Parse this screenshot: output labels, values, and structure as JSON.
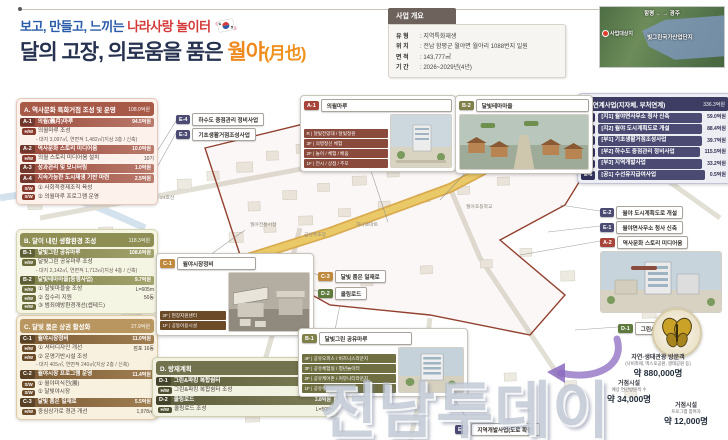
{
  "title": {
    "line1_prefix": "보고, 만들고, 느끼는",
    "line1_accent": "나라사랑 놀이터",
    "line2_prefix": "달의 고장, 의로움을 품은",
    "line2_accent": "월야",
    "line2_hanja": "(月也)"
  },
  "overview": {
    "header": "사업 개요",
    "rows": [
      {
        "k": "유 형",
        "v": ": 지역특화재생"
      },
      {
        "k": "위 치",
        "v": ": 전남 함평군 월야면 월야리 1088번지 일원"
      },
      {
        "k": "면 적",
        "v": ": 143,777㎡"
      },
      {
        "k": "기 간",
        "v": ": 2026~2029년(4년)"
      }
    ]
  },
  "locator": {
    "left_city": "함평",
    "right_city": "광주",
    "arrows": "←  →",
    "zone": "빛그린국가산업단지",
    "site": "사업대상지"
  },
  "sections": {
    "a": {
      "title": "A. 역사문화 특화거점 조성 및 운영",
      "total": "108.0억원",
      "rows": [
        {
          "cls": "head",
          "code": "A-1",
          "name": "의월(義月)마루",
          "rt": "94.5억원"
        },
        {
          "cls": "sub",
          "badge": "H/W",
          "text": "의월마루 조성"
        },
        {
          "cls": "sub note",
          "text": "- 대지 3,097㎡, 연면적 1,482㎡(지상 3층 / 신축)"
        },
        {
          "cls": "head",
          "code": "A-2",
          "name": "역사문화 스토리 미디어움",
          "rt": "10.0억원"
        },
        {
          "cls": "sub",
          "badge": "H/W",
          "text": "의월 스토리 미디어움 설치",
          "rt": "10기"
        },
        {
          "cls": "head",
          "code": "A-3",
          "name": "성과관리 및 모니터링",
          "rt": "1.0억원"
        },
        {
          "cls": "head",
          "code": "A-4",
          "name": "지속가능한 도시재생 기반 마련",
          "rt": "2.5억원"
        },
        {
          "cls": "sub",
          "badge": "S/W",
          "text": "① 사회적경제조직 육성"
        },
        {
          "cls": "sub",
          "badge": "S/W",
          "text": "② 의월마루 프로그램 운영"
        }
      ]
    },
    "b": {
      "title": "B. 달이 내린 생활환경 조성",
      "total": "118.3억원",
      "rows": [
        {
          "cls": "head",
          "code": "B-1",
          "name": "달빛그린 공유마루",
          "rt": "108.6억원"
        },
        {
          "cls": "sub",
          "badge": "H/W",
          "text": "달빛그린 공유마루 조성"
        },
        {
          "cls": "sub note",
          "text": "- 대지 2,142㎡, 연면적 1,713㎡(지상 4층 / 신축)"
        },
        {
          "cls": "head",
          "code": "B-2",
          "name": "달빛테마마을(동행사업)",
          "rt": "9.7억원"
        },
        {
          "cls": "sub",
          "badge": "H/W",
          "text": "① 달빛마을숲 조성",
          "rt": "L=605m"
        },
        {
          "cls": "sub",
          "badge": "H/W",
          "text": "② 집수리 지원",
          "rt": "50동"
        },
        {
          "cls": "sub",
          "badge": "H/W",
          "text": "③ 범죄예방환경개선(셉테드)"
        }
      ]
    },
    "c": {
      "title": "C. 달빛 품은 상권 활성화",
      "total": "27.9억원",
      "rows": [
        {
          "cls": "head",
          "code": "C-1",
          "name": "월야시장정비",
          "rt": "11.0억원"
        },
        {
          "cls": "sub",
          "badge": "H/W",
          "text": "① 셔터디자인 개선",
          "rt": "점포 16동"
        },
        {
          "cls": "sub",
          "badge": "H/W",
          "text": "② 운영기반시설 조성"
        },
        {
          "cls": "sub note",
          "text": "- 대지 405㎡, 연면적 240㎡(지상 2층 / 신축)"
        },
        {
          "cls": "head",
          "code": "C-2",
          "name": "월야시장 프로그램 운영",
          "rt": "11.4억원"
        },
        {
          "cls": "sub",
          "badge": "S/W",
          "text": "① 월야미식전(展)"
        },
        {
          "cls": "sub",
          "badge": "S/W",
          "text": "② 달빛야시장"
        },
        {
          "cls": "head",
          "code": "C-3",
          "name": "달빛 품은 일재로",
          "rt": "5.5억원"
        },
        {
          "cls": "sub",
          "badge": "H/W",
          "text": "중심상가로 경관 개선",
          "rt": "1,978㎡"
        }
      ]
    },
    "d": {
      "title": "D. 방재계획",
      "total": "9.8억원",
      "rows": [
        {
          "cls": "head",
          "code": "D-1",
          "name": "그린&파킹 복합쉼터",
          "rt": "6.0억원"
        },
        {
          "cls": "sub",
          "badge": "H/W",
          "text": "그린&파킹 복합쉼터 조성",
          "rt": "2,358㎡"
        },
        {
          "cls": "head",
          "code": "D-2",
          "name": "쿨링로드",
          "rt": "3.8억원"
        },
        {
          "cls": "sub",
          "badge": "H/W",
          "text": "쿨링로드 조성",
          "rt": "L=505m"
        }
      ]
    },
    "e": {
      "title": "E. 연계사업(지자체, 부처연계)",
      "total": "336.3억원",
      "rows": [
        {
          "cls": "head",
          "code": "E-1",
          "name": "[지1] 월야면사무소 청사 신축",
          "rt": "59.0억원"
        },
        {
          "cls": "head",
          "code": "E-2",
          "name": "[지2] 월야 도시계획도로 개설",
          "rt": "88.4억원"
        },
        {
          "cls": "head",
          "code": "E-3",
          "name": "[부1] 기초생활거점조성사업",
          "rt": "39.7억원"
        },
        {
          "cls": "head",
          "code": "E-4",
          "name": "[부2] 하수도 중점관리 정비사업",
          "rt": "115.5억원"
        },
        {
          "cls": "head",
          "code": "E-5",
          "name": "[부3] 지역개발사업",
          "rt": "33.2억원"
        },
        {
          "cls": "head",
          "code": "E-6",
          "name": "[공1] 수선유지급여사업",
          "rt": "0.5억원"
        }
      ]
    }
  },
  "tags": [
    {
      "code": "E-4",
      "label": "하수도 중점관리 정비사업",
      "type": "e",
      "x": 176,
      "y": 113
    },
    {
      "code": "E-3",
      "label": "기초생활거점조성사업",
      "type": "e",
      "x": 176,
      "y": 128
    },
    {
      "code": "C-3",
      "label": "달빛 품은 일재로",
      "type": "c",
      "x": 318,
      "y": 270
    },
    {
      "code": "D-2",
      "label": "쿨링로드",
      "type": "d",
      "x": 318,
      "y": 287
    },
    {
      "code": "E-2",
      "label": "월야 도시계획도로 개설",
      "type": "e",
      "x": 600,
      "y": 206
    },
    {
      "code": "E-1",
      "label": "월야면사무소 청사 신축",
      "type": "e",
      "x": 600,
      "y": 221
    },
    {
      "code": "A-2",
      "label": "역사문화 스토리 미디어움",
      "type": "a",
      "x": 600,
      "y": 236
    },
    {
      "code": "D-1",
      "label": "그린&파킹 복합쉼터",
      "type": "d",
      "x": 618,
      "y": 322
    },
    {
      "code": "E-5",
      "label": "지역개발사업(도로 확장)",
      "type": "e",
      "x": 455,
      "y": 423
    }
  ],
  "callout_boxes": {
    "a1": {
      "code": "A-1",
      "label": "의월마루",
      "floors": [
        "R | 달빛전망대 / 달빛정원",
        "3F | 의병정신 체험",
        "2F | 놀이 / 체험 / 배움",
        "1F | 전시 / 상점 / 추모"
      ]
    },
    "b2": {
      "code": "B-2",
      "label": "달빛테마마을"
    },
    "c1": {
      "code": "C-1",
      "label": "월야시장정비",
      "floors": [
        "2F | 현장지원센터",
        "1F | 공동이용시설"
      ]
    },
    "b1": {
      "code": "B-1",
      "label": "달빛그린 공유마루",
      "floors": [
        "4F | 공유오피스 / 비즈니스라운지",
        "3F | 공유체험실 / 청년놀이터",
        "2F | 공유케어존 / 커뮤니티라운지",
        "1F | 공유주방 / 복합카페"
      ]
    }
  },
  "map_labels": [
    {
      "text": "국도 24호선",
      "x": 150,
      "y": 194
    },
    {
      "text": "월야전통시장",
      "x": 250,
      "y": 221
    },
    {
      "text": "금성주조장",
      "x": 304,
      "y": 231
    },
    {
      "text": "하나로마트",
      "x": 356,
      "y": 221
    },
    {
      "text": "월야초등학교",
      "x": 466,
      "y": 203
    }
  ],
  "stats": {
    "s1": {
      "l1": "자연·생태관광 방문객",
      "l2": "(나비축제, 엑스포공원, 생태공원 등)",
      "val": "약 880,000명"
    },
    "s2": {
      "l1": "거점시설",
      "l2": "예상 연간방문객 수",
      "val": "약 34,000명"
    },
    "s3": {
      "l1": "거점시설",
      "l2": "프로그램 참여자",
      "val": "약 12,000명"
    }
  },
  "watermark": "전남투데이",
  "colors": {
    "title_blue": "#2a5caa",
    "title_red": "#d43a3a",
    "title_navy": "#263250",
    "title_orange": "#f08a1e",
    "sec_a": "#a85a49",
    "sec_b": "#8e8e55",
    "sec_c": "#b9965f",
    "sec_d": "#72724e",
    "sec_e": "#3d3d63",
    "boundary_red": "#93402f",
    "road_yellow": "#e5c356"
  }
}
